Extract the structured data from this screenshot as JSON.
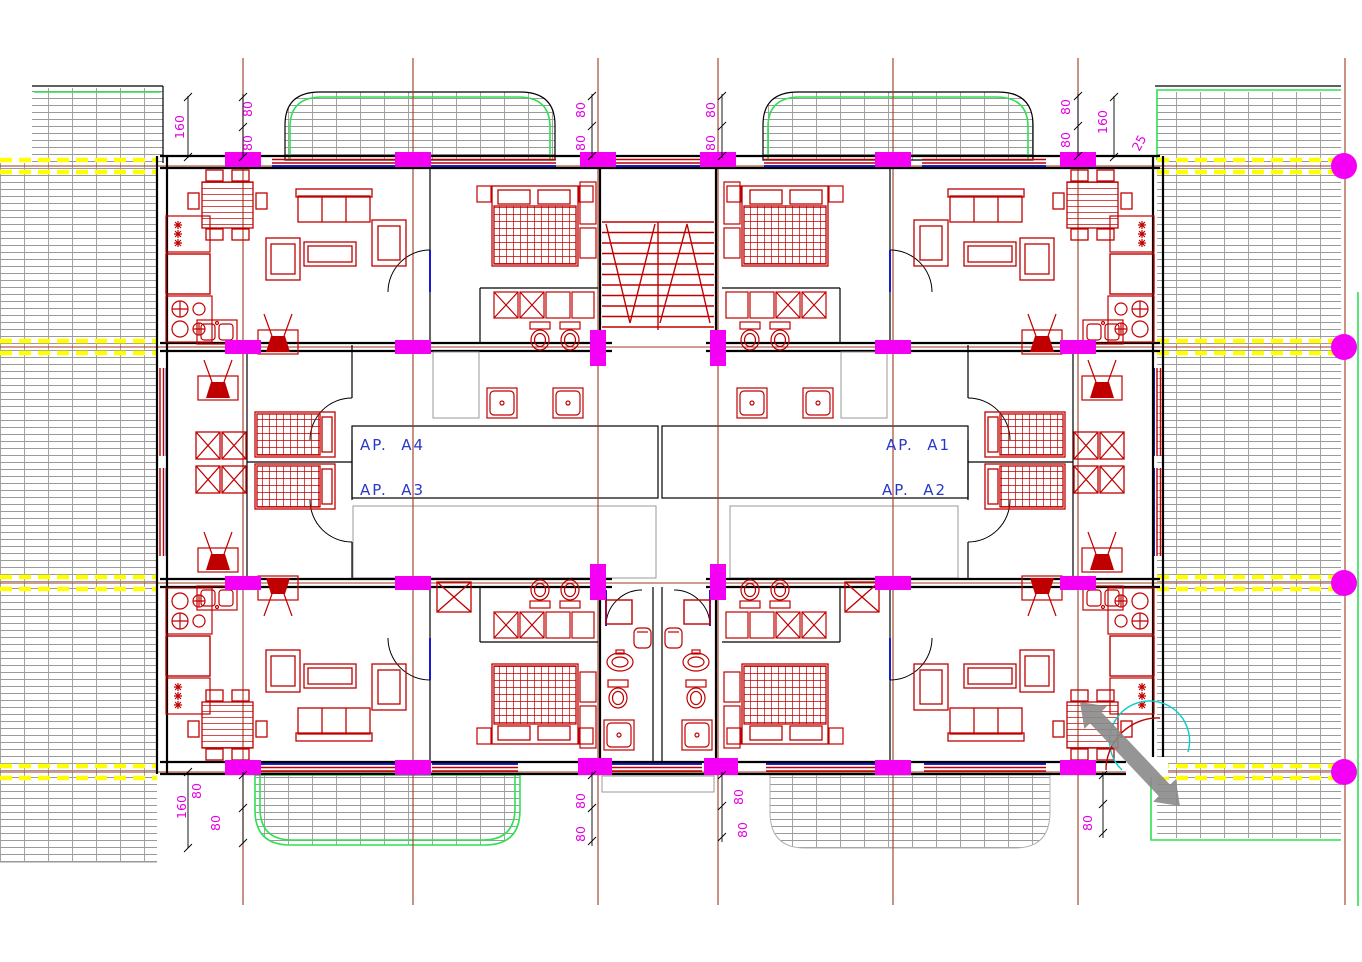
{
  "drawing": {
    "title": "Apartment block floor plan",
    "apartments": {
      "left_top": "AP.  A4",
      "left_bottom": "AP.  A3",
      "right_top": "AP.  A1",
      "right_bottom": "AP.  A2"
    },
    "dims": {
      "tl_160": "160",
      "tl_80a": "80",
      "tl_80b": "80",
      "tcl_80a": "80",
      "tcl_80b": "80",
      "tcr_80a": "80",
      "tcr_80b": "80",
      "tr_80a": "80",
      "tr_80b": "80",
      "tr_160": "160",
      "tr_25": "25",
      "bl_80a": "80",
      "bl_160": "160",
      "bl_80b": "80",
      "bcl_80a": "80",
      "bcl_80b": "80",
      "bcr_80a": "80",
      "bcr_80b": "80",
      "br_80a": "80",
      "br_80b": "80"
    },
    "colors": {
      "walls": "#000000",
      "furniture_red": "#c00000",
      "columns_magenta": "#f400f4",
      "dimension_text_magenta": "#e400e4",
      "grid_axis_brown": "#a03a20",
      "terrace_green": "#2fe052",
      "paving_hatch_gray": "#9a9a9a",
      "survey_line_yellow": "#ffff00",
      "fixture_blue": "#0000c8",
      "door_swing_cyan": "#00cfcf",
      "entry_arrow_gray": "#8a8a8a",
      "label_blue": "#2838c8"
    }
  }
}
